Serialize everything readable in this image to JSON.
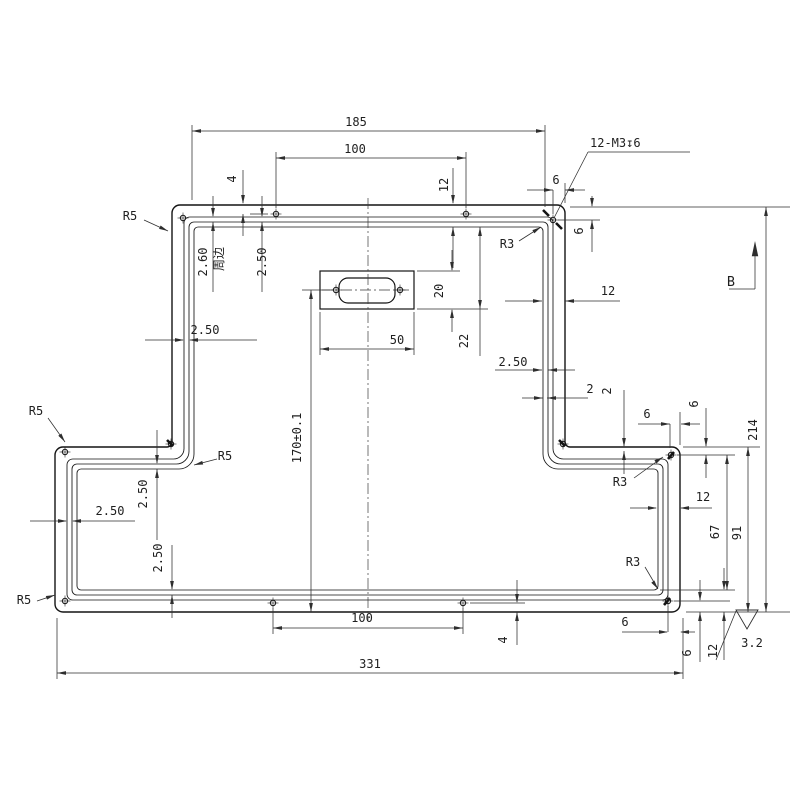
{
  "drawing": {
    "colors": {
      "background": "#ffffff",
      "part_line": "#141414",
      "dim_line": "#2e2e2e",
      "text": "#1f1f1f"
    },
    "callouts": {
      "thread_note": "12-M3↧6",
      "datum": "B",
      "roughness_value": "3.2",
      "perimeter_note": "周边"
    },
    "labels": [
      {
        "id": "dim-185",
        "text": "185",
        "x": 356,
        "y": 126,
        "rot": false
      },
      {
        "id": "dim-100-top",
        "text": "100",
        "x": 355,
        "y": 153,
        "rot": false
      },
      {
        "id": "thread-note",
        "text": "12-M3↧6",
        "x": 590,
        "y": 147,
        "rot": false,
        "anchor": "start"
      },
      {
        "id": "dim-4-top",
        "text": "4",
        "x": 236,
        "y": 179,
        "rot": true
      },
      {
        "id": "dim-12-top",
        "text": "12",
        "x": 448,
        "y": 185,
        "rot": true
      },
      {
        "id": "dim-6-tr-h",
        "text": "6",
        "x": 556,
        "y": 184,
        "rot": false
      },
      {
        "id": "dim-6-tr-v",
        "text": "6",
        "x": 583,
        "y": 231,
        "rot": true
      },
      {
        "id": "r5-top-left",
        "text": "R5",
        "x": 130,
        "y": 220,
        "rot": false
      },
      {
        "id": "r3-top-right",
        "text": "R3",
        "x": 507,
        "y": 248,
        "rot": false
      },
      {
        "id": "dim-260-wall",
        "text": "2.60",
        "x": 207,
        "y": 262,
        "rot": true
      },
      {
        "id": "note-perimeter",
        "text": "周边",
        "x": 223,
        "y": 259,
        "rot": true
      },
      {
        "id": "dim-250-top-left",
        "text": "2.50",
        "x": 266,
        "y": 262,
        "rot": true
      },
      {
        "id": "dim-20",
        "text": "20",
        "x": 443,
        "y": 291,
        "rot": true
      },
      {
        "id": "dim-50",
        "text": "50",
        "x": 397,
        "y": 344,
        "rot": false
      },
      {
        "id": "dim-22",
        "text": "22",
        "x": 468,
        "y": 341,
        "rot": true
      },
      {
        "id": "dim-12-right",
        "text": "12",
        "x": 608,
        "y": 295,
        "rot": false
      },
      {
        "id": "dim-250-right",
        "text": "2.50",
        "x": 513,
        "y": 366,
        "rot": false
      },
      {
        "id": "dim-250-left-wall",
        "text": "2.50",
        "x": 205,
        "y": 334,
        "rot": false
      },
      {
        "id": "datum-b",
        "text": "B",
        "x": 731,
        "y": 286,
        "rot": false
      },
      {
        "id": "dim-2-h",
        "text": "2",
        "x": 590,
        "y": 393,
        "rot": false
      },
      {
        "id": "dim-2-v",
        "text": "2",
        "x": 611,
        "y": 391,
        "rot": true
      },
      {
        "id": "dim-6-step-h",
        "text": "6",
        "x": 647,
        "y": 418,
        "rot": false
      },
      {
        "id": "dim-6-step-v",
        "text": "6",
        "x": 698,
        "y": 404,
        "rot": true
      },
      {
        "id": "r3-right-step",
        "text": "R3",
        "x": 620,
        "y": 486,
        "rot": false
      },
      {
        "id": "dim-214",
        "text": "214",
        "x": 757,
        "y": 430,
        "rot": true
      },
      {
        "id": "r5-left-step-outer",
        "text": "R5",
        "x": 36,
        "y": 415,
        "rot": false
      },
      {
        "id": "r5-left-step-inner",
        "text": "R5",
        "x": 225,
        "y": 460,
        "rot": false
      },
      {
        "id": "dim-250-left-step",
        "text": "2.50",
        "x": 147,
        "y": 494,
        "rot": true
      },
      {
        "id": "dim-250-bottom-left-h",
        "text": "2.50",
        "x": 110,
        "y": 515,
        "rot": false
      },
      {
        "id": "dim-12-flange-right",
        "text": "12",
        "x": 703,
        "y": 501,
        "rot": false
      },
      {
        "id": "dim-67",
        "text": "67",
        "x": 719,
        "y": 532,
        "rot": true
      },
      {
        "id": "dim-91",
        "text": "91",
        "x": 741,
        "y": 533,
        "rot": true
      },
      {
        "id": "dim-250-bottom-left-v",
        "text": "2.50",
        "x": 162,
        "y": 558,
        "rot": true
      },
      {
        "id": "r5-bottom-left",
        "text": "R5",
        "x": 24,
        "y": 604,
        "rot": false
      },
      {
        "id": "r3-bottom-right",
        "text": "R3",
        "x": 633,
        "y": 566,
        "rot": false
      },
      {
        "id": "dim-170",
        "text": "170±0.1",
        "x": 301,
        "y": 438,
        "rot": true
      },
      {
        "id": "dim-100-bottom",
        "text": "100",
        "x": 362,
        "y": 622,
        "rot": false
      },
      {
        "id": "dim-4-bottom",
        "text": "4",
        "x": 507,
        "y": 640,
        "rot": true
      },
      {
        "id": "dim-331",
        "text": "331",
        "x": 370,
        "y": 668,
        "rot": false
      },
      {
        "id": "dim-6-br-h",
        "text": "6",
        "x": 625,
        "y": 626,
        "rot": false
      },
      {
        "id": "dim-6-br-v",
        "text": "6",
        "x": 691,
        "y": 653,
        "rot": true
      },
      {
        "id": "dim-12-br-v",
        "text": "12",
        "x": 717,
        "y": 651,
        "rot": true
      },
      {
        "id": "roughness-value",
        "text": "3.2",
        "x": 752,
        "y": 647,
        "rot": false
      }
    ]
  }
}
